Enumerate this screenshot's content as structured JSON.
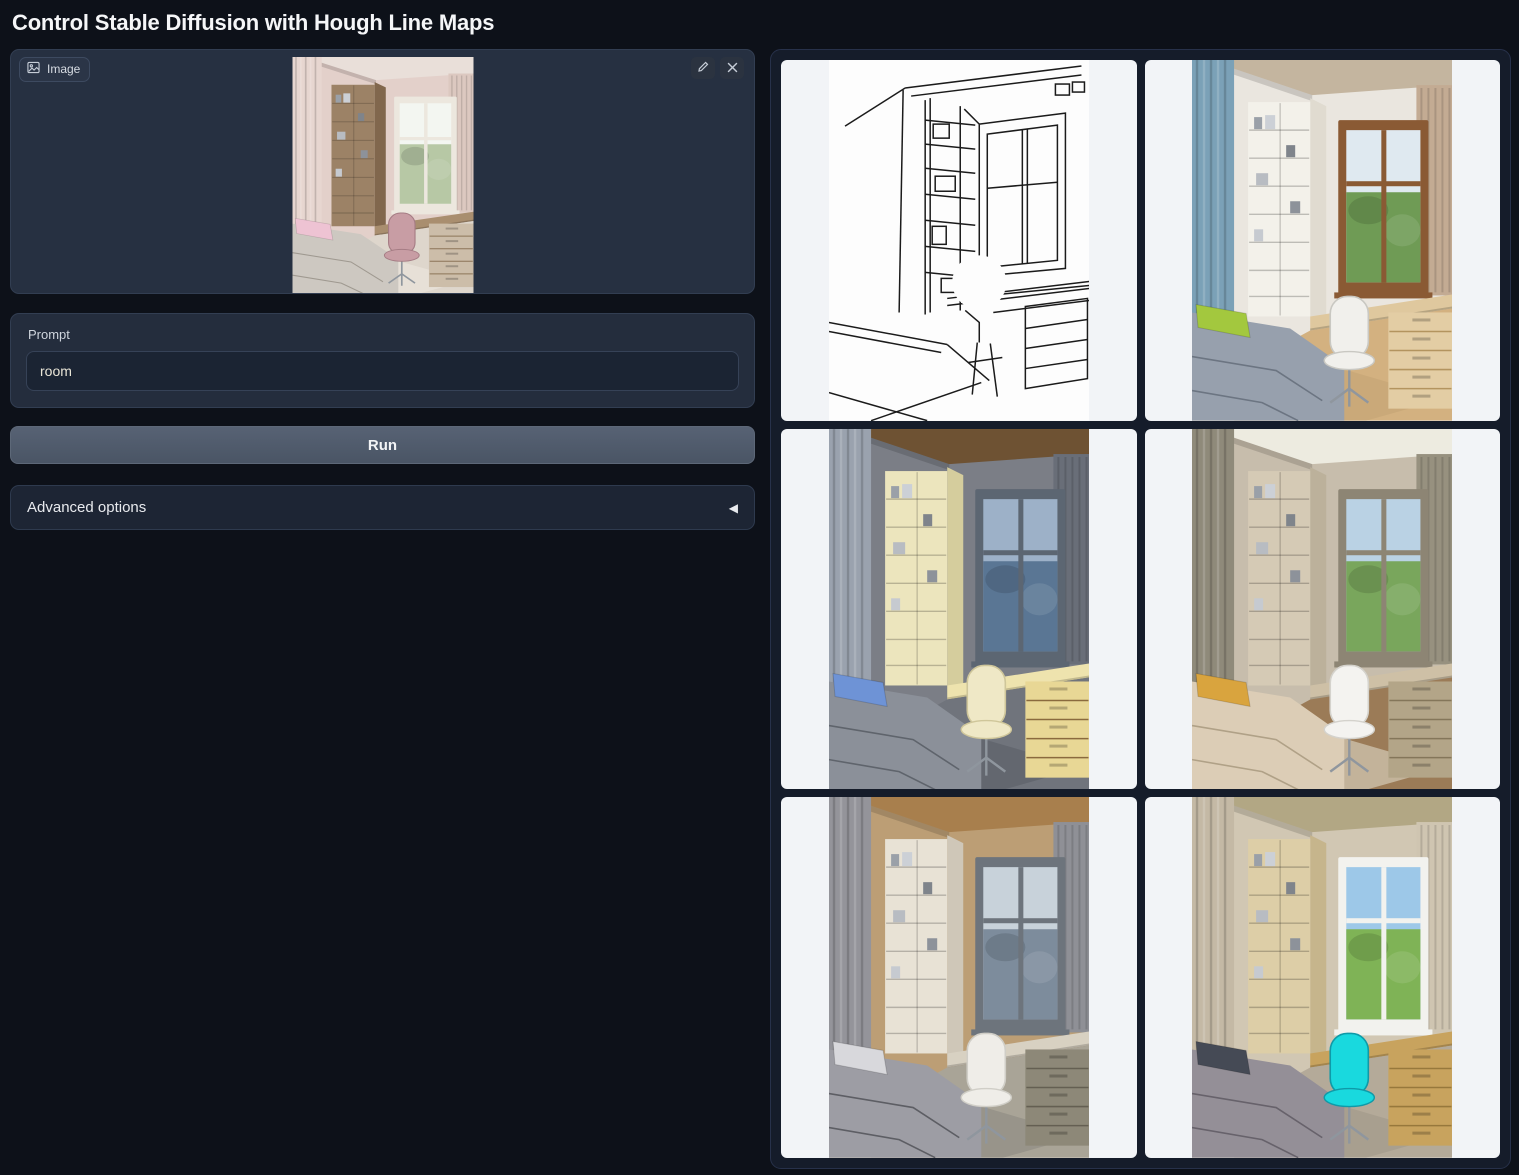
{
  "header": {
    "title": "Control Stable Diffusion with Hough Line Maps"
  },
  "image_input": {
    "label": "Image",
    "name": "kids-bedroom-photo",
    "edit_label": "Edit",
    "clear_label": "Clear",
    "palette": {
      "wall": "#e3d0ca",
      "ceiling": "#e9dfd9",
      "curtainL": "#e7d6d0",
      "curtainR": "#dcc8c0",
      "shelf": "#9c8266",
      "shelfSide": "#81674d",
      "frame": "#ece7de",
      "sky": "#f3f6f1",
      "green": "#b7c8a5",
      "desk": "#a98e6f",
      "drawers": "#ccbda9",
      "drawerLine": "#8b7559",
      "chair": "#c89da4",
      "chairDark": "#a57c84",
      "bed": "#cdc8c1",
      "bedDark": "#9f9990",
      "pillow": "#eec3d3",
      "floor": "#ded6cc",
      "rug": "#e8e1d8"
    }
  },
  "prompt": {
    "label": "Prompt",
    "value": "room"
  },
  "run_button": {
    "label": "Run"
  },
  "advanced_options": {
    "label": "Advanced options"
  },
  "colors": {
    "page_bg": "#0d1119",
    "panel_bg": "#242d3d",
    "panel_border": "#323e52",
    "card_bg": "#f2f4f7",
    "run_button_bg": "#515c6d",
    "accent_text": "#f5f6f8"
  },
  "gallery": {
    "items": [
      {
        "name": "hough-line-map",
        "type": "sketch"
      },
      {
        "name": "generated-room-1",
        "type": "photo",
        "palette": {
          "wall": "#eae6df",
          "ceiling": "#c4b59f",
          "curtainL": "#7ba1b7",
          "curtainR": "#c3ab93",
          "shelf": "#f3f1ea",
          "shelfSide": "#e0dbd0",
          "frame": "#8a5a34",
          "sky": "#dfe9f0",
          "green": "#6f9b55",
          "desk": "#dfc89e",
          "drawers": "#e3cda4",
          "drawerLine": "#b3945f",
          "chair": "#f1f0ec",
          "chairDark": "#c9c8c2",
          "bed": "#97a0ad",
          "bedDark": "#6c7582",
          "pillow": "#a3c83e",
          "floor": "#d3b180",
          "rug": "#c9a878"
        }
      },
      {
        "name": "generated-room-2",
        "type": "photo",
        "palette": {
          "wall": "#7b7e86",
          "ceiling": "#6e5233",
          "curtainL": "#9aa2ae",
          "curtainR": "#696e78",
          "shelf": "#ece5bd",
          "shelfSide": "#d5cd9d",
          "frame": "#5c6672",
          "sky": "#9db1c8",
          "green": "#5a7694",
          "desk": "#eee3ae",
          "drawers": "#e8d795",
          "drawerLine": "#8a6a3e",
          "chair": "#efe8c6",
          "chairDark": "#cfc69a",
          "bed": "#8b9099",
          "bedDark": "#5f646c",
          "pillow": "#6e93d6",
          "floor": "#70747c",
          "rug": "#62666e"
        }
      },
      {
        "name": "generated-room-3",
        "type": "photo",
        "palette": {
          "wall": "#c7bdac",
          "ceiling": "#edebe0",
          "curtainL": "#8f8a7a",
          "curtainR": "#97917f",
          "shelf": "#d5cab5",
          "shelfSide": "#bcb19b",
          "frame": "#8d8574",
          "sky": "#bad2e4",
          "green": "#79a65c",
          "desk": "#cec0a6",
          "drawers": "#b3a588",
          "drawerLine": "#84765a",
          "chair": "#f4f3f0",
          "chairDark": "#d4d2cc",
          "bed": "#dccdb6",
          "bedDark": "#b0a187",
          "pillow": "#d9a43e",
          "floor": "#9b7b57",
          "rug": "#c8b9a2"
        }
      },
      {
        "name": "generated-room-4",
        "type": "photo",
        "palette": {
          "wall": "#bc9e75",
          "ceiling": "#a87f4d",
          "curtainL": "#94949a",
          "curtainR": "#8f9096",
          "shelf": "#e8e2d5",
          "shelfSide": "#cfc7b8",
          "frame": "#6d747c",
          "sky": "#c8d2da",
          "green": "#7d8c9c",
          "desk": "#d8d1c2",
          "drawers": "#8d8878",
          "drawerLine": "#645f52",
          "chair": "#efede8",
          "chairDark": "#d0cec7",
          "bed": "#9d9da4",
          "bedDark": "#5d5e64",
          "pillow": "#d8d8dc",
          "floor": "#a9a497",
          "rug": "#969288"
        }
      },
      {
        "name": "generated-room-5",
        "type": "photo",
        "palette": {
          "wall": "#d1c7b3",
          "ceiling": "#b2a784",
          "curtainL": "#c4b9a5",
          "curtainR": "#cfc5b1",
          "shelf": "#ddcea7",
          "shelfSide": "#c6b58c",
          "frame": "#f2f2ee",
          "sky": "#9dc8e8",
          "green": "#7fb356",
          "desk": "#c8a35e",
          "drawers": "#c8a35e",
          "drawerLine": "#97783c",
          "chair": "#19d9de",
          "chairDark": "#0f9aa8",
          "bed": "#948f97",
          "bedDark": "#67626b",
          "pillow": "#454a55",
          "floor": "#b4aa99",
          "rug": "#a69d8e"
        }
      }
    ]
  }
}
